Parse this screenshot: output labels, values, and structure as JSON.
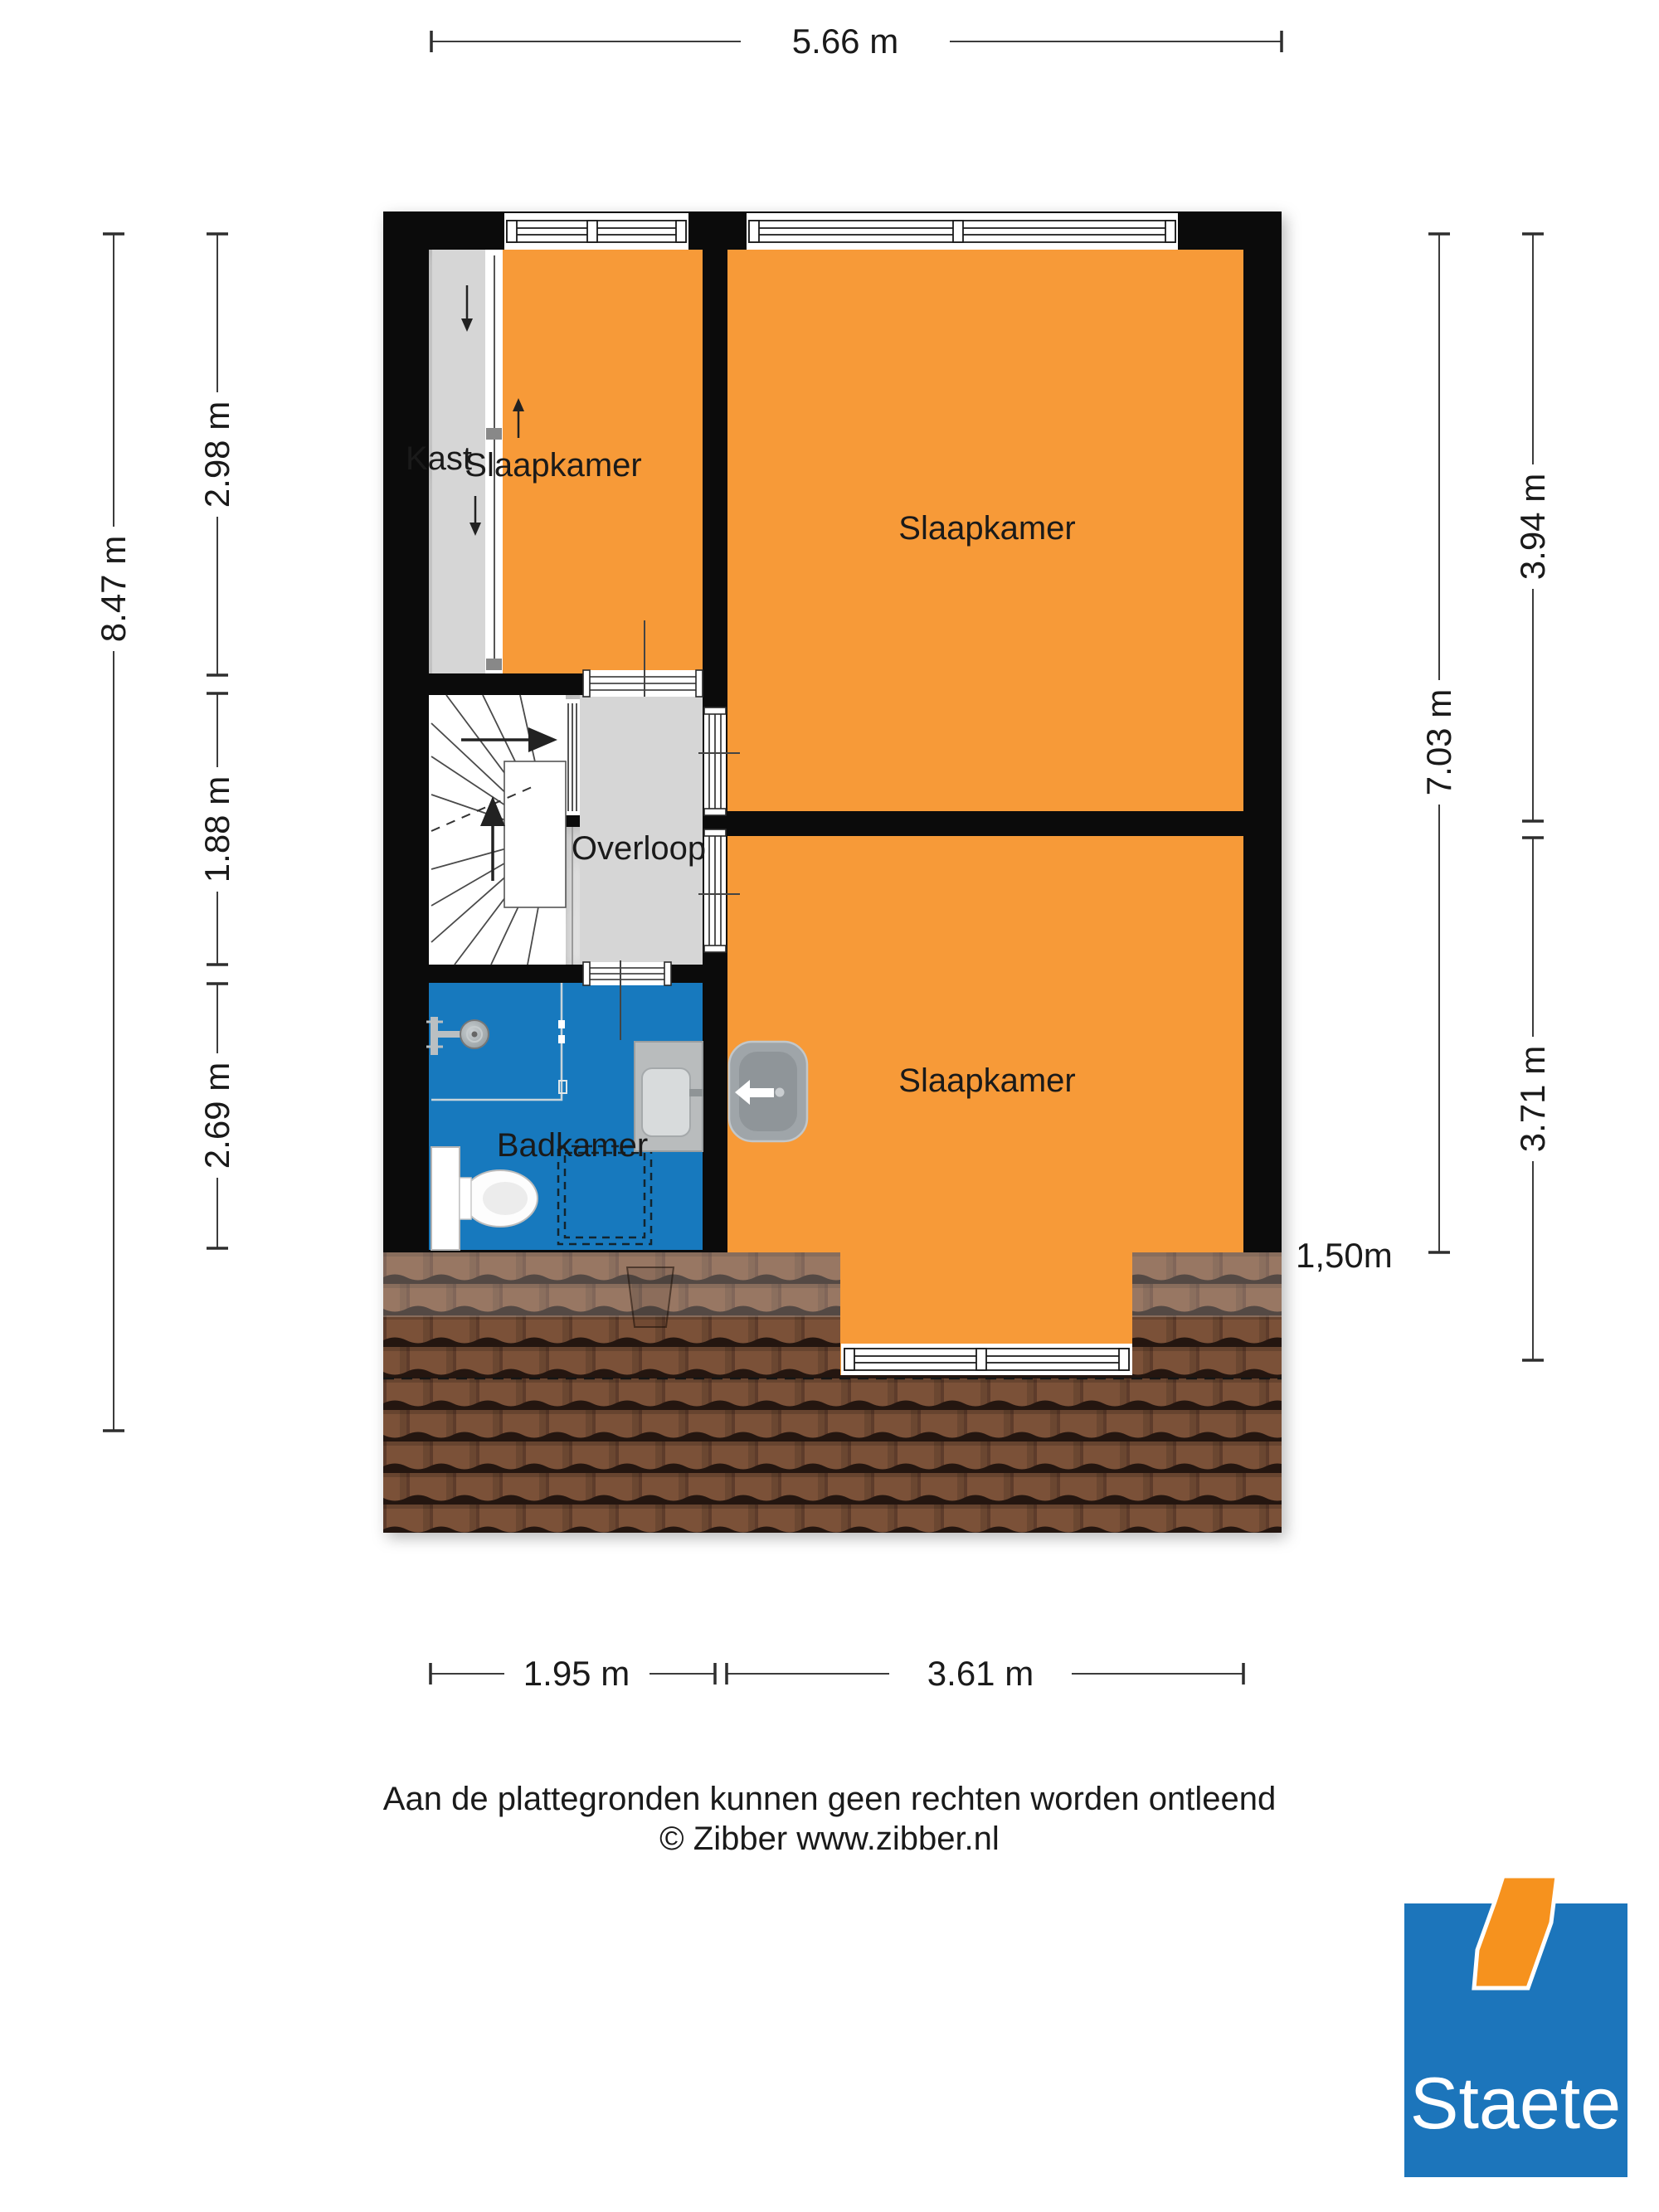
{
  "rooms": {
    "kast": "Kast",
    "slaapkamer": "Slaapkamer",
    "overloop": "Overloop",
    "badkamer": "Badkamer"
  },
  "dimensions": {
    "top_width": "5.66 m",
    "left_overall": "8.47 m",
    "left_segments": [
      "2.98 m",
      "1.88 m",
      "2.69 m"
    ],
    "right_overall": "7.03 m",
    "right_segments": [
      "3.94 m",
      "3.71 m"
    ],
    "bottom_segments": [
      "1.95 m",
      "3.61 m"
    ],
    "headroom": "1,50m"
  },
  "footer": {
    "line1": "Aan de plattegronden kunnen geen rechten worden ontleend",
    "line2": "© Zibber www.zibber.nl"
  },
  "logo": {
    "text": "Staete"
  },
  "colors": {
    "room_orange": "#F79A38",
    "bathroom_blue": "#1779BE",
    "hall_gray": "#D6D6D6",
    "wall_black": "#0B0B0B",
    "roof_brown": "#7B5138",
    "roof_dark": "#5E3C2B",
    "roof_edge": "#241610",
    "logo_blue": "#1C75BB",
    "logo_orange": "#F6921E",
    "dim_line": "#3C3C3C",
    "text": "#1A1A1A"
  }
}
